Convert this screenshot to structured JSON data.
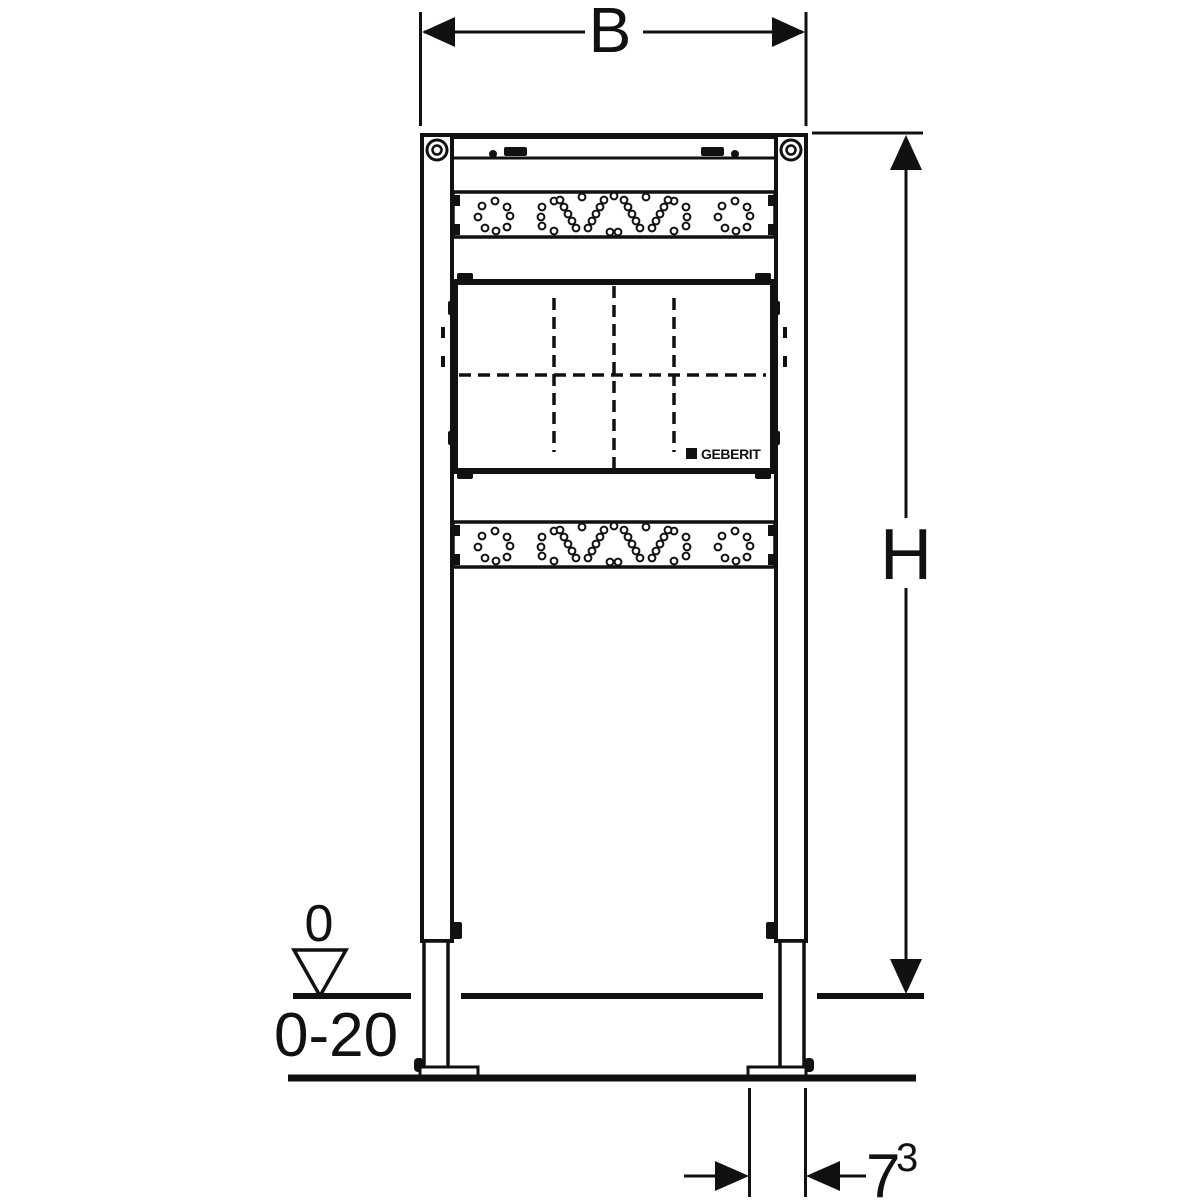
{
  "drawing": {
    "brand": {
      "label": "GEBERIT"
    },
    "dimensions": {
      "width_label": "B",
      "height_label": "H",
      "datum_zero_label": "0",
      "floor_finish_range_label": "0-20",
      "foot_depth_value": "7",
      "foot_depth_footnote": "3"
    },
    "colors": {
      "line": "#111111",
      "background": "#ffffff"
    }
  }
}
